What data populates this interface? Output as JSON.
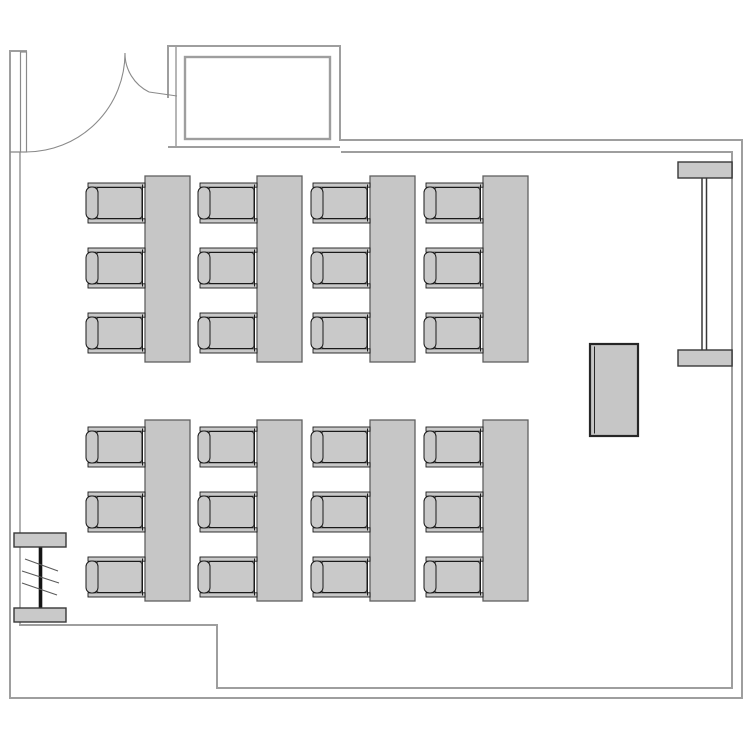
{
  "document": {
    "type": "floor-plan",
    "subject": "classroom seating layout"
  },
  "canvas": {
    "width": 750,
    "height": 750,
    "background": "#ffffff"
  },
  "colors": {
    "wall": "#9e9e9e",
    "thin": "#8a8a8a",
    "furn_fill": "#c9c9c9",
    "furn_stroke": "#1a1a1a",
    "table_fill": "#c6c6c6",
    "table_stroke": "#606060",
    "cap_stroke": "#383838",
    "desk_stroke": "#262626",
    "pipe": "#141414",
    "hatch": "#5a5a5a",
    "white": "#ffffff",
    "none": "none"
  },
  "plan": {
    "rects": [
      {
        "name": "door-leaf-open",
        "x": 20.5,
        "y": 52,
        "w": 6,
        "h": 100,
        "rx": 0,
        "f": "white",
        "s": "thin",
        "sw": 1.2
      },
      {
        "name": "vestibule-inner-wall",
        "x": 185,
        "y": 57,
        "w": 145,
        "h": 82,
        "rx": 0,
        "f": "none",
        "s": "wall",
        "sw": 2.4
      },
      {
        "name": "radiator-right-cap-top",
        "x": 678,
        "y": 162,
        "w": 54,
        "h": 16,
        "rx": 0,
        "f": "furn_fill",
        "s": "cap_stroke",
        "sw": 1.4
      },
      {
        "name": "radiator-right-cap-bottom",
        "x": 678,
        "y": 350,
        "w": 54,
        "h": 16,
        "rx": 0,
        "f": "furn_fill",
        "s": "cap_stroke",
        "sw": 1.4
      },
      {
        "name": "radiator-left-cap-top",
        "x": 14,
        "y": 533,
        "w": 52,
        "h": 14,
        "rx": 0,
        "f": "furn_fill",
        "s": "cap_stroke",
        "sw": 1.4
      },
      {
        "name": "radiator-left-cap-bottom",
        "x": 14,
        "y": 608,
        "w": 52,
        "h": 14,
        "rx": 0,
        "f": "furn_fill",
        "s": "cap_stroke",
        "sw": 1.4
      },
      {
        "name": "storage-desk",
        "x": 590,
        "y": 344,
        "w": 48,
        "h": 92,
        "rx": 0,
        "f": "table_fill",
        "s": "desk_stroke",
        "sw": 2.2
      }
    ],
    "lines": [
      {
        "name": "left-wall-outer",
        "x1": 10,
        "y1": 50,
        "x2": 10,
        "y2": 698,
        "c": "wall",
        "w": 2
      },
      {
        "name": "left-wall-top-cap",
        "x1": 9,
        "y1": 51,
        "x2": 27,
        "y2": 51,
        "c": "wall",
        "w": 2
      },
      {
        "name": "left-wall-inner",
        "x1": 20,
        "y1": 152,
        "x2": 20,
        "y2": 625,
        "c": "wall",
        "w": 1.6
      },
      {
        "name": "door-sill-cap",
        "x1": 10,
        "y1": 152,
        "x2": 21,
        "y2": 152,
        "c": "thin",
        "w": 1.3
      },
      {
        "name": "bottom-left-inner-wall",
        "x1": 19,
        "y1": 625,
        "x2": 217,
        "y2": 625,
        "c": "wall",
        "w": 2
      },
      {
        "name": "bottom-step-wall",
        "x1": 217,
        "y1": 624,
        "x2": 217,
        "y2": 689,
        "c": "wall",
        "w": 2
      },
      {
        "name": "bottom-inner-wall",
        "x1": 216,
        "y1": 688,
        "x2": 733,
        "y2": 688,
        "c": "wall",
        "w": 2
      },
      {
        "name": "right-inner-wall",
        "x1": 732,
        "y1": 152,
        "x2": 732,
        "y2": 689,
        "c": "wall",
        "w": 2
      },
      {
        "name": "top-inner-wall",
        "x1": 341,
        "y1": 152,
        "x2": 733,
        "y2": 152,
        "c": "wall",
        "w": 2
      },
      {
        "name": "top-outer-wall",
        "x1": 340,
        "y1": 140,
        "x2": 742,
        "y2": 140,
        "c": "wall",
        "w": 2
      },
      {
        "name": "right-outer-wall",
        "x1": 742,
        "y1": 139,
        "x2": 742,
        "y2": 699,
        "c": "wall",
        "w": 2
      },
      {
        "name": "bottom-outer-wall",
        "x1": 9,
        "y1": 698,
        "x2": 743,
        "y2": 698,
        "c": "wall",
        "w": 2
      },
      {
        "name": "vestibule-top-wall",
        "x1": 167,
        "y1": 46,
        "x2": 341,
        "y2": 46,
        "c": "wall",
        "w": 2
      },
      {
        "name": "vestibule-right-wall",
        "x1": 340,
        "y1": 45,
        "x2": 340,
        "y2": 141,
        "c": "wall",
        "w": 2
      },
      {
        "name": "vestibule-bottom-wall",
        "x1": 168,
        "y1": 147,
        "x2": 340,
        "y2": 147,
        "c": "wall",
        "w": 2
      },
      {
        "name": "vestibule-left-outer-wall",
        "x1": 168,
        "y1": 45,
        "x2": 168,
        "y2": 98,
        "c": "wall",
        "w": 2
      },
      {
        "name": "vestibule-left-inner-wall",
        "x1": 176,
        "y1": 47,
        "x2": 176,
        "y2": 147,
        "c": "wall",
        "w": 1.5
      },
      {
        "name": "door-leaf-small",
        "x1": 149,
        "y1": 92,
        "x2": 177,
        "y2": 96,
        "c": "thin",
        "w": 1.1
      },
      {
        "name": "radiator-right-pipe-left",
        "x1": 702,
        "y1": 162,
        "x2": 702,
        "y2": 366,
        "c": "cap_stroke",
        "w": 1.5
      },
      {
        "name": "radiator-right-pipe-right",
        "x1": 706.5,
        "y1": 162,
        "x2": 706.5,
        "y2": 366,
        "c": "cap_stroke",
        "w": 1.5
      },
      {
        "name": "radiator-left-pipe",
        "x1": 40.5,
        "y1": 533,
        "x2": 40.5,
        "y2": 622,
        "c": "pipe",
        "w": 3.6
      },
      {
        "name": "radiator-left-hatch-1",
        "x1": 25,
        "y1": 559,
        "x2": 58,
        "y2": 571,
        "c": "hatch",
        "w": 1.1
      },
      {
        "name": "radiator-left-hatch-2",
        "x1": 22,
        "y1": 571,
        "x2": 59,
        "y2": 583,
        "c": "hatch",
        "w": 1.1
      },
      {
        "name": "radiator-left-hatch-3",
        "x1": 22,
        "y1": 583,
        "x2": 57,
        "y2": 595,
        "c": "hatch",
        "w": 1.1
      },
      {
        "name": "storage-desk-inner-edge",
        "x1": 594.5,
        "y1": 346.5,
        "x2": 594.5,
        "y2": 433.5,
        "c": "desk_stroke",
        "w": 1
      }
    ],
    "paths": [
      {
        "name": "door-swing-arc-large",
        "d": "M 26 152 A 99 99 0 0 0 125 53",
        "c": "thin",
        "w": 1.1
      },
      {
        "name": "door-swing-arc-small",
        "d": "M 125 53 A 43 43 0 0 0 149 92",
        "c": "thin",
        "w": 1.1
      }
    ],
    "desk_layout": {
      "columns_x": [
        86,
        198,
        311,
        424
      ],
      "table": {
        "offset_x": 59,
        "width": 45,
        "fill": "table_fill",
        "stroke": "table_stroke",
        "sw": 1.3
      },
      "groups": [
        {
          "name": "front-desk-group",
          "table_y": 176,
          "table_h": 186,
          "chair_ys": [
            183,
            248,
            313
          ]
        },
        {
          "name": "back-desk-group",
          "table_y": 420,
          "table_h": 181,
          "chair_ys": [
            427,
            492,
            557
          ]
        }
      ],
      "chair": {
        "arm": {
          "x": 2,
          "w": 57,
          "h": 4.2,
          "bottom_y": 35.8
        },
        "connector_x": 56.5,
        "seat": {
          "x": 10,
          "y": 4.5,
          "w": 46,
          "h": 31,
          "rx": 3
        },
        "back": {
          "x": 0,
          "y": 4,
          "w": 12,
          "h": 32,
          "rx": 5.5
        },
        "fill": "furn_fill",
        "stroke": "furn_stroke",
        "sw": 1
      },
      "counts": {
        "tables": 8,
        "chairs": 24,
        "chairs_per_table": 3
      }
    }
  }
}
